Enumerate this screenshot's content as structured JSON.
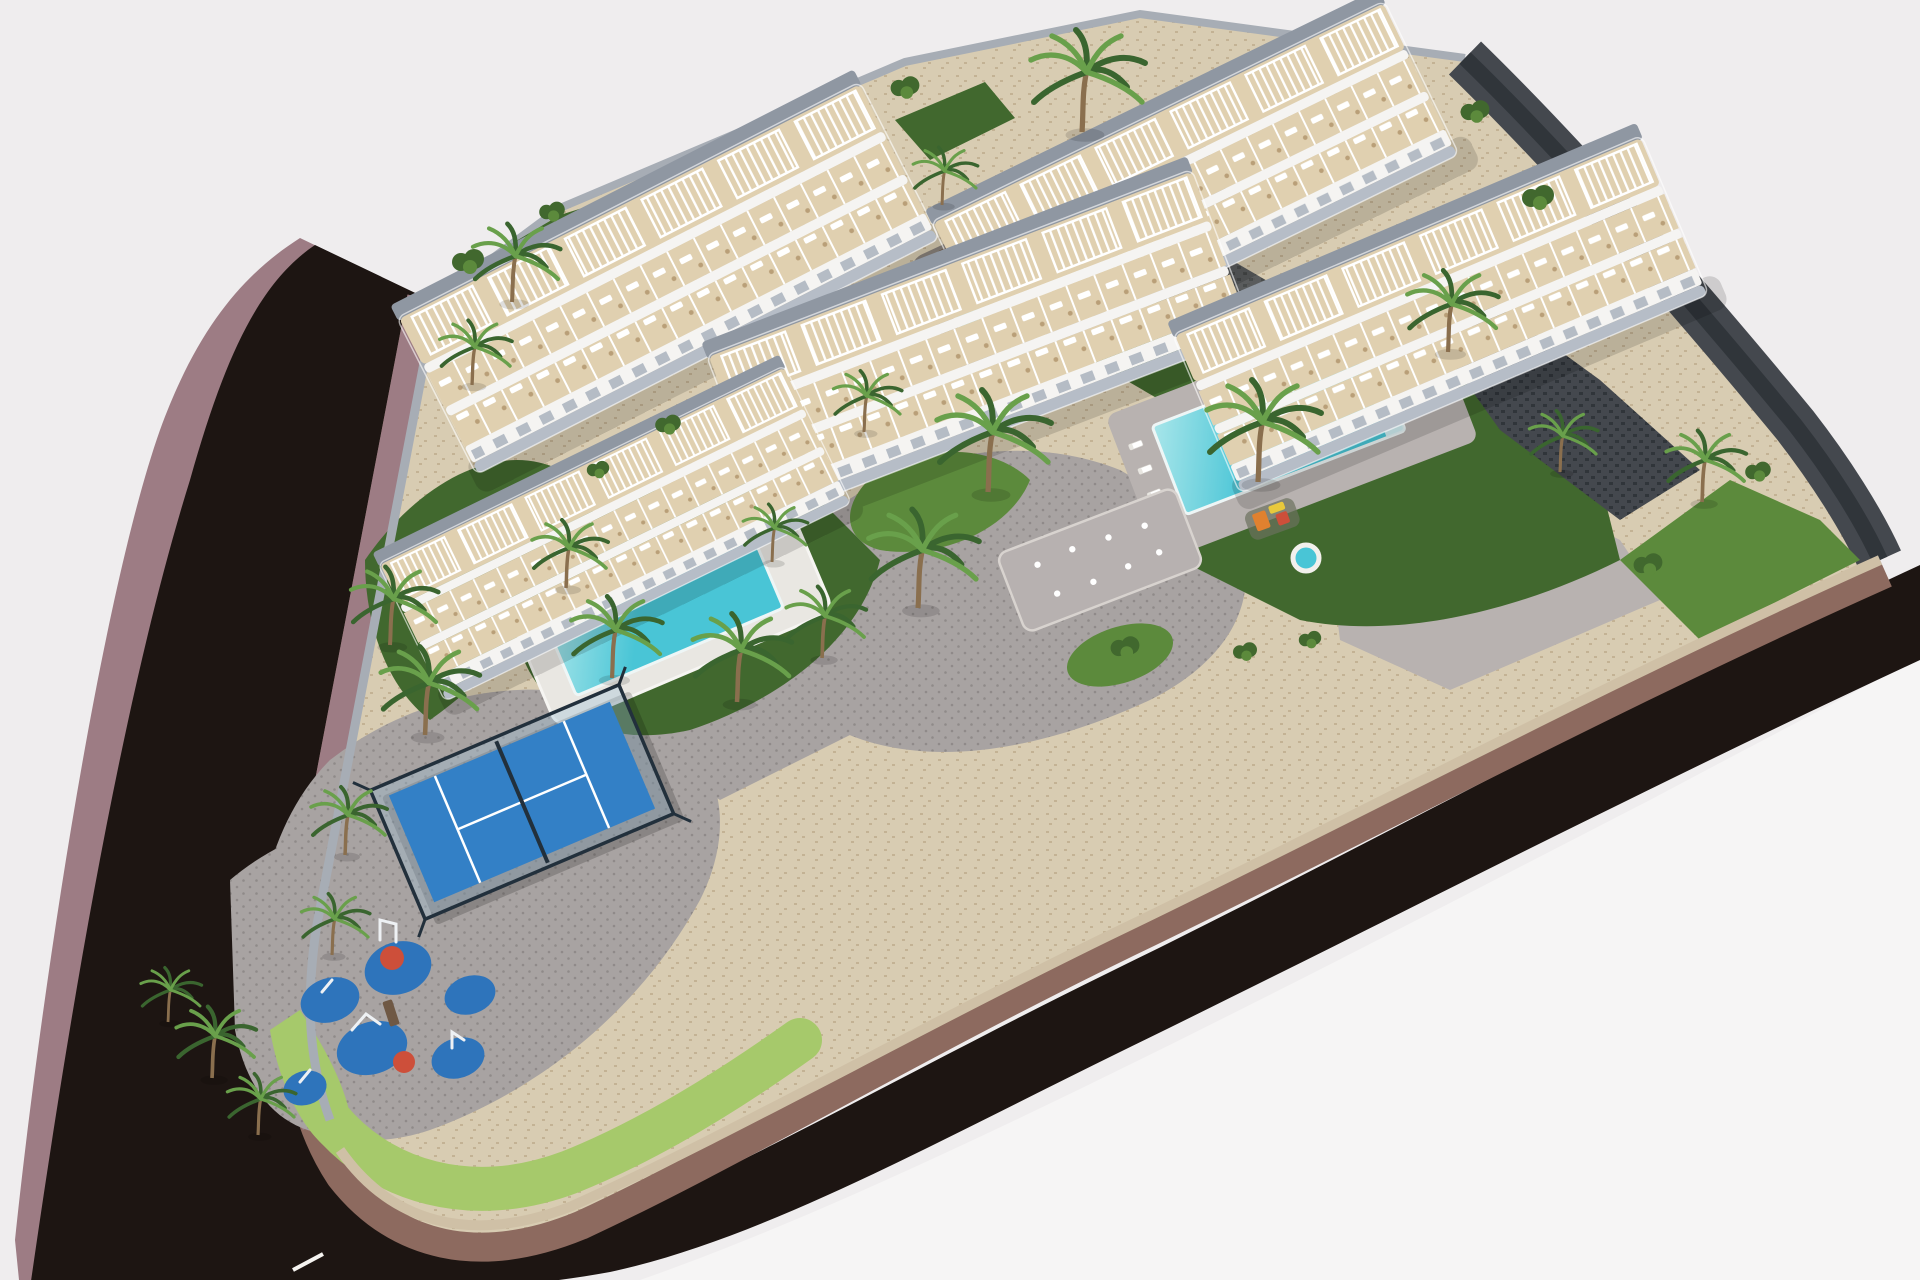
{
  "scene": {
    "title": "Aerial 3D architectural rendering of a white residential complex with pools, palm gardens, padel court and playground, wrapped by a dark curving road",
    "view": "isometric aerial render on a plain pale background",
    "colors": {
      "background": "#efedee",
      "background_light": "#f6f5f5",
      "road_asphalt": "#1d1512",
      "road_marking": "#f5f3f0",
      "sidewalk_mauve": "#9d7c84",
      "sidewalk_brown": "#8d6a5f",
      "platform_stone": "#d8ccb2",
      "platform_speckle": "#c3b294",
      "paving_gray": "#a8a3a2",
      "paving_dot": "#8f8a89",
      "paving_light": "#b8b2b0",
      "wall_tan": "#cfc0a6",
      "wall_gray": "#a7adb5",
      "wall_dark": "#44484e",
      "wall_dark_inner": "#30353a",
      "building_white": "#f5f4f2",
      "building_back": "#8f97a2",
      "building_base": "#b6bdc7",
      "terrace_tan": "#e0d0b0",
      "furniture_wood": "#b99f78",
      "window_gray": "#aeb6c0",
      "lawn_dark": "#41682e",
      "lawn_mid": "#5c8a3c",
      "lawn_light": "#a6c96b",
      "palm_dark": "#3a652f",
      "palm_light": "#69a04b",
      "palm_trunk": "#8a6f4e",
      "pool_water": "#49c5d6",
      "pool_water_light": "#a9e6ea",
      "pool_deck_dark": "#8b847c",
      "pool_rim": "#eef6f6",
      "daybed_wood": "#6f5844",
      "padel_blue": "#3380c6",
      "padel_frame": "#22303c",
      "padel_glass": "#9fc0d8",
      "play_blue": "#2e74bb",
      "play_red": "#cd4f3a",
      "play_orange": "#e0812f",
      "play_yellow": "#e8c93c"
    },
    "buildings": [
      {
        "id": "block-a",
        "label": "apartment block - north-west",
        "style": "white 3-storey terraced block, tan roof terraces with white pergolas"
      },
      {
        "id": "block-b",
        "label": "apartment block - north-east",
        "style": "white 3-storey terraced block, tan roof terraces with white pergolas"
      },
      {
        "id": "block-c",
        "label": "apartment block - centre",
        "style": "white 3-storey terraced block, tan roof terraces with white pergolas"
      },
      {
        "id": "block-d",
        "label": "apartment block - east",
        "style": "white 3-storey terraced block, tan roof terraces with white pergolas"
      },
      {
        "id": "block-e",
        "label": "apartment block - south-west",
        "style": "white 3-storey terraced block, tan roof terraces with white pergolas"
      }
    ],
    "water_features": [
      {
        "id": "pool-north",
        "label": "communal pool on dark deck between north blocks"
      },
      {
        "id": "pool-east",
        "label": "communal pool with beach steps beside east block"
      },
      {
        "id": "pool-south",
        "label": "walled garden pool below south-west block"
      },
      {
        "id": "spa-round",
        "label": "small round spa pool"
      },
      {
        "id": "splash-pad",
        "label": "fountain splash pad in central courtyard",
        "jets": 8
      }
    ],
    "amenities": [
      {
        "id": "padel-court",
        "label": "fenced blue padel court with glass walls"
      },
      {
        "id": "playground",
        "label": "corner playground on blue safety pads",
        "blue_pads": 6,
        "red_pads": 2
      },
      {
        "id": "kids-slide",
        "label": "small colourful slide unit near east pool"
      }
    ],
    "landscape": {
      "palms": "palm clusters in planters and lawns across the site",
      "lawns": "dark lawns around the pools with a light green verge at the south-west corner",
      "road": "dark asphalt road with mauve pavements curving along the west and south boundary",
      "road_marking": "white centre-line dash at the south-west corner",
      "boundary": "dark stone perimeter wall along the north-east edge"
    }
  }
}
